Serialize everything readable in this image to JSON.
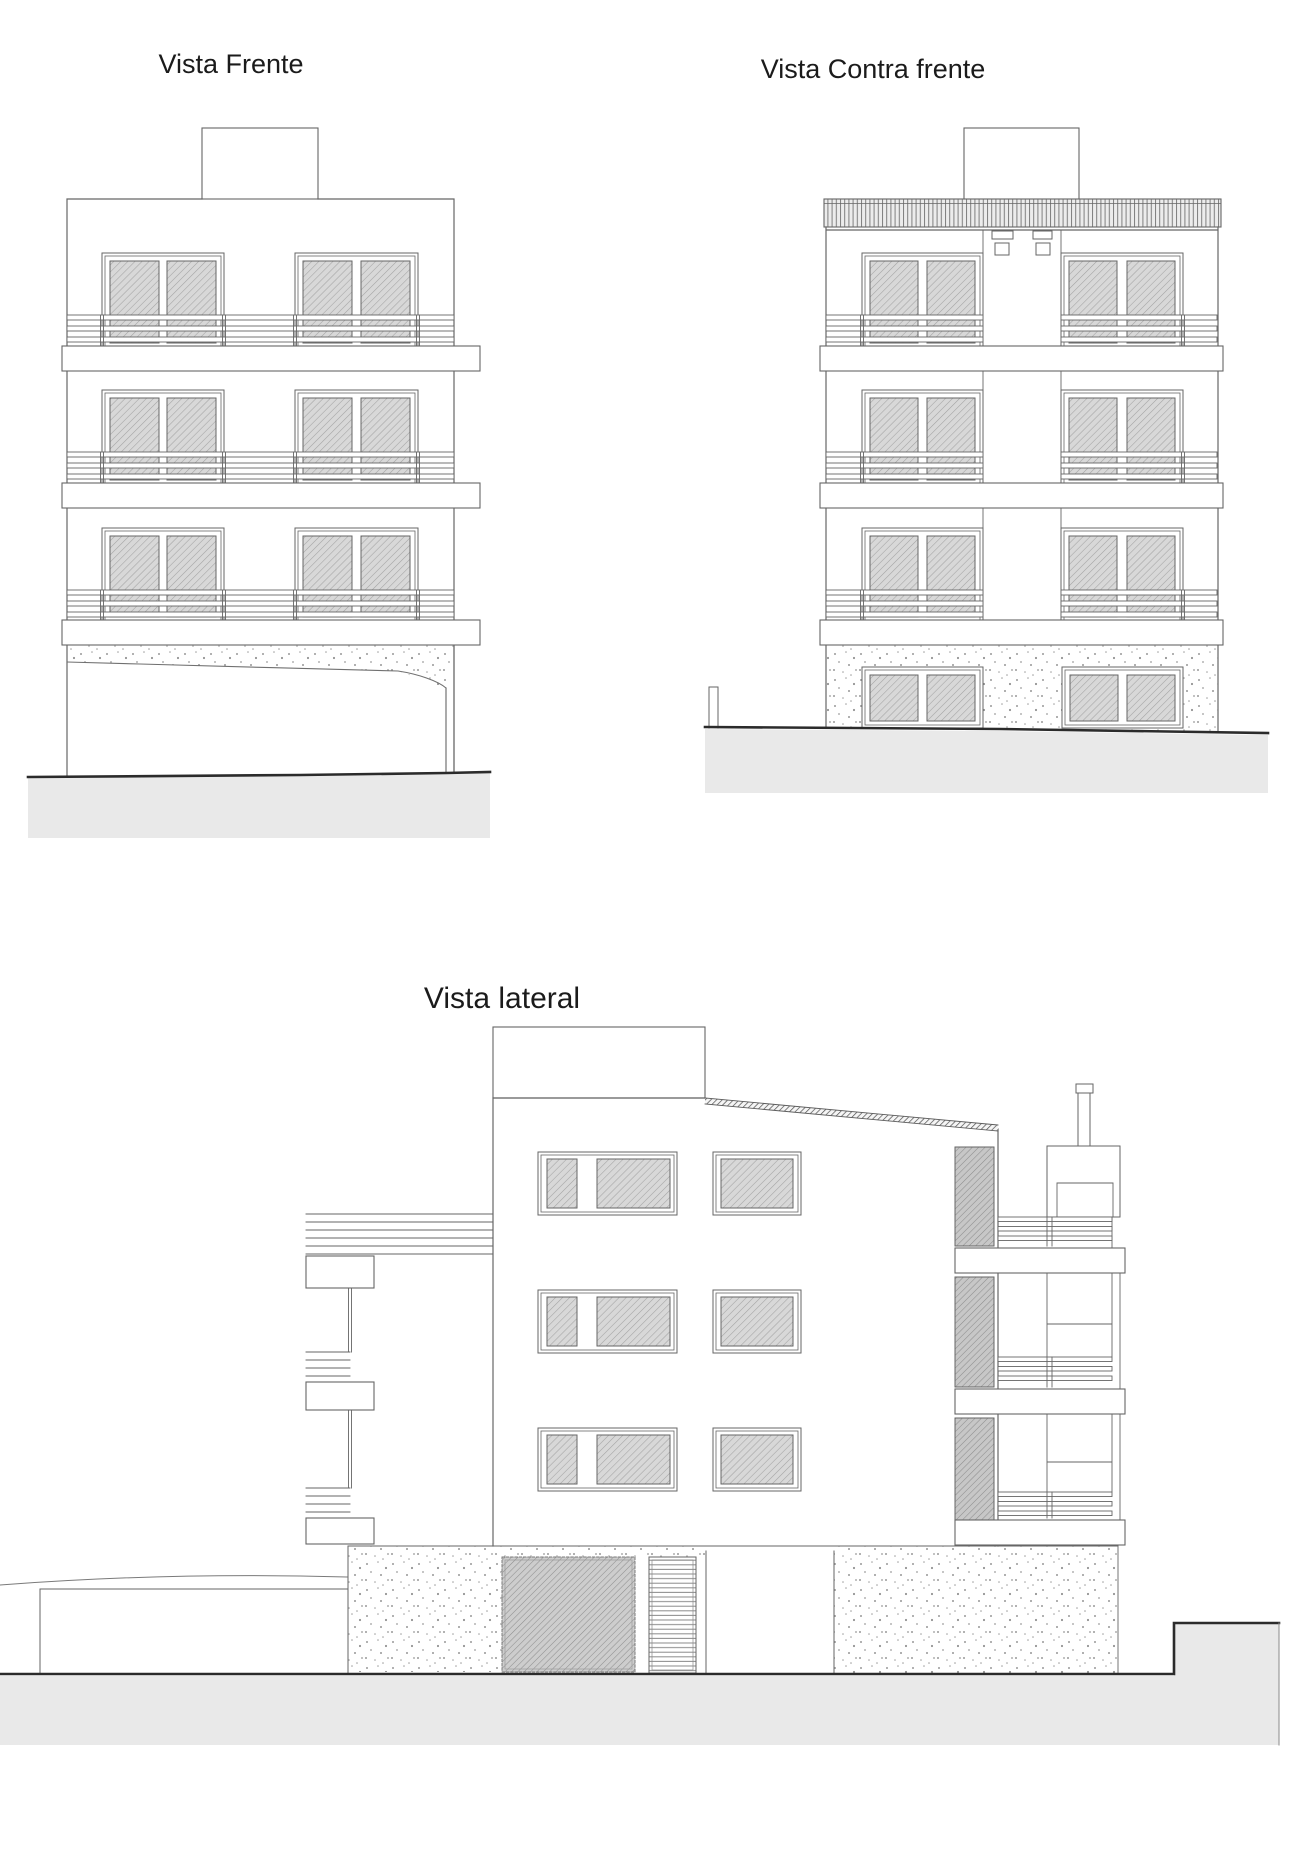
{
  "drawing": {
    "type": "architectural-elevations",
    "sheet_background": "#ffffff",
    "views": [
      {
        "id": "front",
        "title": "Vista Frente"
      },
      {
        "id": "rear",
        "title": "Vista Contra frente"
      },
      {
        "id": "side",
        "title": "Vista lateral"
      }
    ],
    "elements": {
      "floors_visible": 3,
      "roof_bulkhead": "stair bulkhead on roof",
      "ground": "sloped terrain band"
    }
  },
  "colors": {
    "line": "#666666",
    "dark_ground_line": "#2b2b2b",
    "title_text": "#1b1b1b",
    "glass_fill": "#d8d8d8",
    "glass_hatch": "#a3a3a3",
    "screen_fill": "#c7c7c7",
    "ground_fill": "#e9e9e9",
    "concrete_dots": "#999999",
    "corrugation_fill": "#ececec"
  }
}
